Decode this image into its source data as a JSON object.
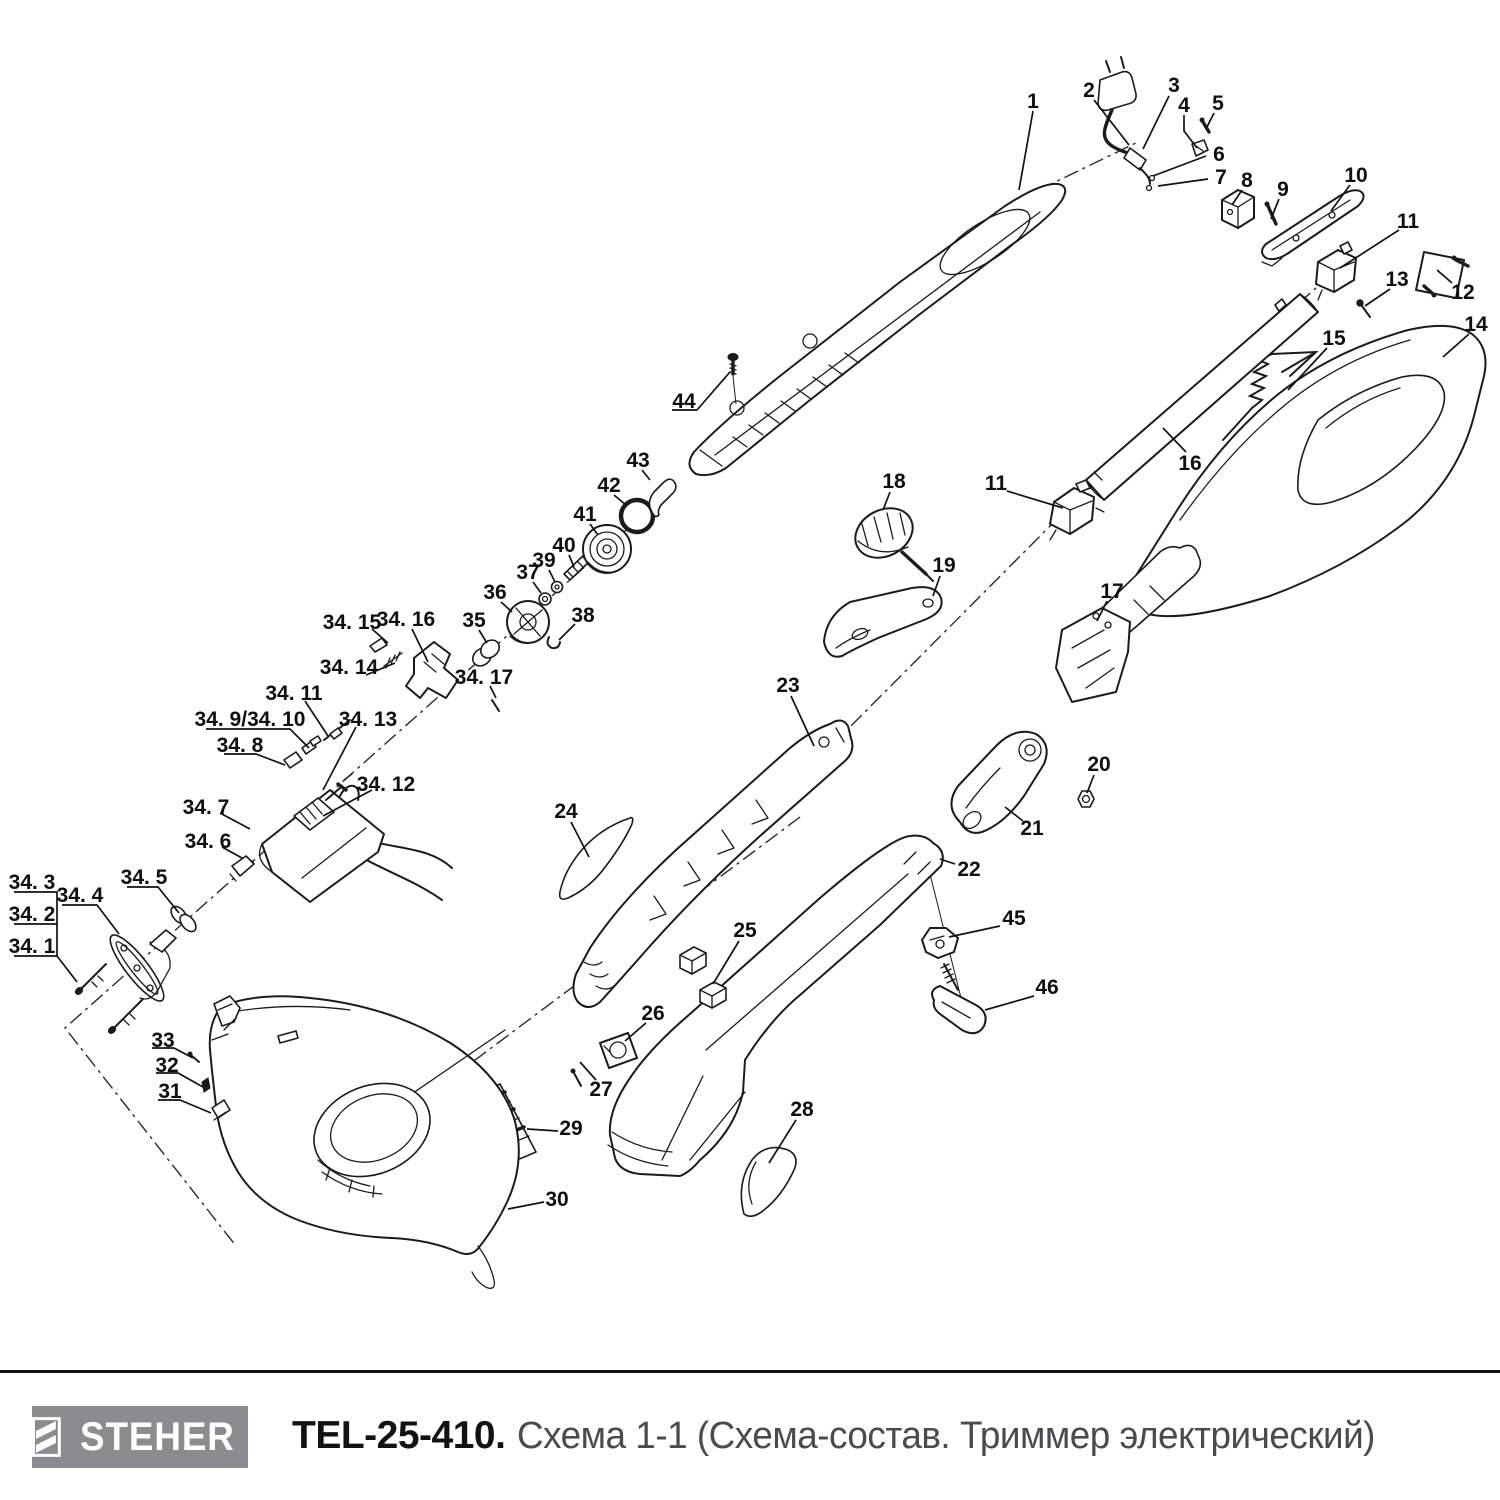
{
  "footer": {
    "brand": "STEHER",
    "model": "TEL-25-410.",
    "subtitle": "Схема 1-1 (Схема-состав. Триммер электрический)",
    "logo_bg": "#8a8c8f",
    "subtitle_color": "#4a4b4d",
    "line_color": "#111111"
  },
  "diagram": {
    "description": "Exploded parts view of electric trimmer",
    "line_art_color": "#1b1b1b",
    "labels": [
      {
        "id": "1",
        "text": "1",
        "x": 1033,
        "y": 100,
        "leader": [
          [
            1033,
            111
          ],
          [
            1019,
            190
          ]
        ]
      },
      {
        "id": "2",
        "text": "2",
        "x": 1089,
        "y": 89,
        "leader": [
          [
            1094,
            100
          ],
          [
            1129,
            145
          ]
        ]
      },
      {
        "id": "3",
        "text": "3",
        "x": 1174,
        "y": 84,
        "leader": [
          [
            1169,
            96
          ],
          [
            1143,
            149
          ]
        ]
      },
      {
        "id": "4",
        "text": "4",
        "x": 1184,
        "y": 104,
        "leader": [
          [
            1184,
            115
          ],
          [
            1184,
            131
          ],
          [
            1197,
            148
          ]
        ]
      },
      {
        "id": "5",
        "text": "5",
        "x": 1218,
        "y": 102,
        "leader": [
          [
            1214,
            113
          ],
          [
            1206,
            129
          ]
        ]
      },
      {
        "id": "6",
        "text": "6",
        "x": 1219,
        "y": 153,
        "leader": [
          [
            1206,
            156
          ],
          [
            1153,
            176
          ]
        ]
      },
      {
        "id": "7",
        "text": "7",
        "x": 1221,
        "y": 176,
        "leader": [
          [
            1208,
            179
          ],
          [
            1158,
            186
          ]
        ]
      },
      {
        "id": "8",
        "text": "8",
        "x": 1247,
        "y": 179,
        "leader": [
          [
            1242,
            190
          ],
          [
            1232,
            205
          ]
        ]
      },
      {
        "id": "9",
        "text": "9",
        "x": 1283,
        "y": 188,
        "leader": [
          [
            1279,
            199
          ],
          [
            1271,
            219
          ]
        ]
      },
      {
        "id": "10",
        "text": "10",
        "x": 1356,
        "y": 174,
        "leader": [
          [
            1350,
            185
          ],
          [
            1331,
            211
          ]
        ]
      },
      {
        "id": "11",
        "text": "11",
        "x": 1408,
        "y": 220,
        "leader": [
          [
            1399,
            230
          ],
          [
            1340,
            268
          ]
        ]
      },
      {
        "id": "12",
        "text": "12",
        "x": 1463,
        "y": 291,
        "leader": [
          [
            1452,
            283
          ],
          [
            1437,
            270
          ]
        ]
      },
      {
        "id": "13",
        "text": "13",
        "x": 1397,
        "y": 278,
        "leader": [
          [
            1390,
            289
          ],
          [
            1365,
            306
          ]
        ]
      },
      {
        "id": "14",
        "text": "14",
        "x": 1476,
        "y": 323,
        "leader": [
          [
            1469,
            334
          ],
          [
            1443,
            357
          ]
        ]
      },
      {
        "id": "15",
        "text": "15",
        "x": 1334,
        "y": 337,
        "leader": [
          [
            1327,
            348
          ],
          [
            1288,
            390
          ]
        ]
      },
      {
        "id": "16",
        "text": "16",
        "x": 1190,
        "y": 462,
        "leader": [
          [
            1186,
            452
          ],
          [
            1163,
            428
          ]
        ]
      },
      {
        "id": "11b",
        "text": "11",
        "x": 996,
        "y": 482,
        "leader": [
          [
            1007,
            491
          ],
          [
            1063,
            508
          ]
        ]
      },
      {
        "id": "17",
        "text": "17",
        "x": 1112,
        "y": 590,
        "leader": [
          [
            1107,
            601
          ],
          [
            1097,
            621
          ]
        ]
      },
      {
        "id": "18",
        "text": "18",
        "x": 894,
        "y": 480,
        "leader": [
          [
            890,
            492
          ],
          [
            883,
            510
          ]
        ]
      },
      {
        "id": "19",
        "text": "19",
        "x": 944,
        "y": 564,
        "leader": [
          [
            940,
            576
          ],
          [
            933,
            596
          ]
        ]
      },
      {
        "id": "20",
        "text": "20",
        "x": 1099,
        "y": 763,
        "leader": [
          [
            1094,
            775
          ],
          [
            1087,
            793
          ]
        ]
      },
      {
        "id": "21",
        "text": "21",
        "x": 1032,
        "y": 827,
        "leader": [
          [
            1023,
            821
          ],
          [
            1005,
            807
          ]
        ]
      },
      {
        "id": "22",
        "text": "22",
        "x": 969,
        "y": 868,
        "leader": [
          [
            955,
            864
          ],
          [
            940,
            859
          ]
        ]
      },
      {
        "id": "23",
        "text": "23",
        "x": 788,
        "y": 684,
        "leader": [
          [
            791,
            696
          ],
          [
            814,
            746
          ]
        ]
      },
      {
        "id": "24",
        "text": "24",
        "x": 566,
        "y": 810,
        "leader": [
          [
            571,
            822
          ],
          [
            589,
            857
          ]
        ]
      },
      {
        "id": "25",
        "text": "25",
        "x": 745,
        "y": 929,
        "leader": [
          [
            739,
            941
          ],
          [
            713,
            984
          ]
        ]
      },
      {
        "id": "26",
        "text": "26",
        "x": 653,
        "y": 1012,
        "leader": [
          [
            646,
            1023
          ],
          [
            625,
            1041
          ]
        ]
      },
      {
        "id": "27",
        "text": "27",
        "x": 601,
        "y": 1088,
        "leader": [
          [
            596,
            1080
          ],
          [
            580,
            1062
          ]
        ]
      },
      {
        "id": "28",
        "text": "28",
        "x": 802,
        "y": 1108,
        "leader": [
          [
            796,
            1120
          ],
          [
            769,
            1163
          ]
        ]
      },
      {
        "id": "29",
        "text": "29",
        "x": 571,
        "y": 1127,
        "leader": [
          [
            558,
            1131
          ],
          [
            527,
            1129
          ]
        ]
      },
      {
        "id": "30",
        "text": "30",
        "x": 557,
        "y": 1198,
        "leader": [
          [
            544,
            1202
          ],
          [
            508,
            1209
          ]
        ]
      },
      {
        "id": "31",
        "text": "31",
        "x": 170,
        "y": 1090,
        "leader": [
          [
            158,
            1100
          ],
          [
            180,
            1100
          ],
          [
            211,
            1113
          ]
        ]
      },
      {
        "id": "32",
        "text": "32",
        "x": 167,
        "y": 1064,
        "leader": [
          [
            156,
            1073
          ],
          [
            178,
            1073
          ],
          [
            203,
            1087
          ]
        ]
      },
      {
        "id": "33",
        "text": "33",
        "x": 163,
        "y": 1039,
        "leader": [
          [
            152,
            1048
          ],
          [
            174,
            1048
          ],
          [
            193,
            1058
          ]
        ]
      },
      {
        "id": "34-1",
        "text": "34. 1",
        "x": 32,
        "y": 945,
        "leader": [
          [
            14,
            956
          ],
          [
            57,
            956
          ],
          [
            77,
            982
          ]
        ]
      },
      {
        "id": "34-2",
        "text": "34. 2",
        "x": 32,
        "y": 913,
        "leader": [
          [
            14,
            924
          ],
          [
            57,
            924
          ],
          [
            57,
            956
          ]
        ]
      },
      {
        "id": "34-3",
        "text": "34. 3",
        "x": 32,
        "y": 881,
        "leader": [
          [
            14,
            892
          ],
          [
            57,
            892
          ],
          [
            57,
            924
          ]
        ]
      },
      {
        "id": "34-4",
        "text": "34. 4",
        "x": 80,
        "y": 894,
        "leader": [
          [
            62,
            905
          ],
          [
            97,
            905
          ],
          [
            119,
            934
          ]
        ]
      },
      {
        "id": "34-5",
        "text": "34. 5",
        "x": 144,
        "y": 876,
        "leader": [
          [
            127,
            887
          ],
          [
            158,
            887
          ],
          [
            179,
            913
          ]
        ]
      },
      {
        "id": "34-6",
        "text": "34. 6",
        "x": 208,
        "y": 840,
        "leader": [
          [
            222,
            847
          ],
          [
            242,
            858
          ]
        ]
      },
      {
        "id": "34-7",
        "text": "34. 7",
        "x": 206,
        "y": 806,
        "leader": [
          [
            220,
            813
          ],
          [
            250,
            829
          ]
        ]
      },
      {
        "id": "34-8",
        "text": "34. 8",
        "x": 240,
        "y": 744,
        "leader": [
          [
            224,
            754
          ],
          [
            256,
            754
          ],
          [
            285,
            765
          ]
        ]
      },
      {
        "id": "34-9-10",
        "text": "34. 9/34. 10",
        "x": 250,
        "y": 718,
        "leader": [
          [
            206,
            729
          ],
          [
            290,
            729
          ],
          [
            309,
            748
          ]
        ]
      },
      {
        "id": "34-11",
        "text": "34. 11",
        "x": 294,
        "y": 692,
        "leader": [
          [
            305,
            701
          ],
          [
            328,
            736
          ]
        ]
      },
      {
        "id": "34-12",
        "text": "34. 12",
        "x": 386,
        "y": 783,
        "leader": [
          [
            372,
            790
          ],
          [
            323,
            816
          ]
        ]
      },
      {
        "id": "34-13",
        "text": "34. 13",
        "x": 368,
        "y": 718,
        "leader": [
          [
            356,
            727
          ],
          [
            323,
            790
          ]
        ]
      },
      {
        "id": "34-14",
        "text": "34. 14",
        "x": 349,
        "y": 666,
        "leader": [
          [
            366,
            675
          ],
          [
            395,
            663
          ]
        ]
      },
      {
        "id": "34-15",
        "text": "34. 15",
        "x": 352,
        "y": 621,
        "leader": [
          [
            372,
            629
          ],
          [
            388,
            643
          ]
        ]
      },
      {
        "id": "34-16",
        "text": "34. 16",
        "x": 406,
        "y": 618,
        "leader": [
          [
            412,
            629
          ],
          [
            428,
            662
          ]
        ]
      },
      {
        "id": "34-17",
        "text": "34. 17",
        "x": 484,
        "y": 676,
        "leader": [
          [
            490,
            686
          ],
          [
            496,
            698
          ]
        ]
      },
      {
        "id": "35",
        "text": "35",
        "x": 474,
        "y": 619,
        "leader": [
          [
            479,
            630
          ],
          [
            487,
            643
          ]
        ]
      },
      {
        "id": "36",
        "text": "36",
        "x": 495,
        "y": 591,
        "leader": [
          [
            501,
            602
          ],
          [
            512,
            612
          ]
        ]
      },
      {
        "id": "37",
        "text": "37",
        "x": 528,
        "y": 571,
        "leader": [
          [
            533,
            582
          ],
          [
            541,
            593
          ]
        ]
      },
      {
        "id": "38",
        "text": "38",
        "x": 583,
        "y": 614,
        "leader": [
          [
            575,
            624
          ],
          [
            559,
            640
          ]
        ]
      },
      {
        "id": "39",
        "text": "39",
        "x": 544,
        "y": 559,
        "leader": [
          [
            549,
            570
          ],
          [
            555,
            582
          ]
        ]
      },
      {
        "id": "40",
        "text": "40",
        "x": 564,
        "y": 544,
        "leader": [
          [
            569,
            555
          ],
          [
            574,
            567
          ]
        ]
      },
      {
        "id": "41",
        "text": "41",
        "x": 585,
        "y": 513,
        "leader": [
          [
            590,
            524
          ],
          [
            598,
            535
          ]
        ]
      },
      {
        "id": "42",
        "text": "42",
        "x": 609,
        "y": 484,
        "leader": [
          [
            614,
            495
          ],
          [
            626,
            505
          ]
        ]
      },
      {
        "id": "43",
        "text": "43",
        "x": 638,
        "y": 459,
        "leader": [
          [
            642,
            470
          ],
          [
            650,
            480
          ]
        ]
      },
      {
        "id": "44",
        "text": "44",
        "x": 684,
        "y": 400,
        "leader": [
          [
            672,
            410
          ],
          [
            697,
            410
          ],
          [
            730,
            372
          ]
        ]
      },
      {
        "id": "45",
        "text": "45",
        "x": 1014,
        "y": 917,
        "leader": [
          [
            1000,
            926
          ],
          [
            949,
            937
          ]
        ]
      },
      {
        "id": "46",
        "text": "46",
        "x": 1047,
        "y": 986,
        "leader": [
          [
            1034,
            996
          ],
          [
            985,
            1010
          ]
        ]
      }
    ]
  }
}
